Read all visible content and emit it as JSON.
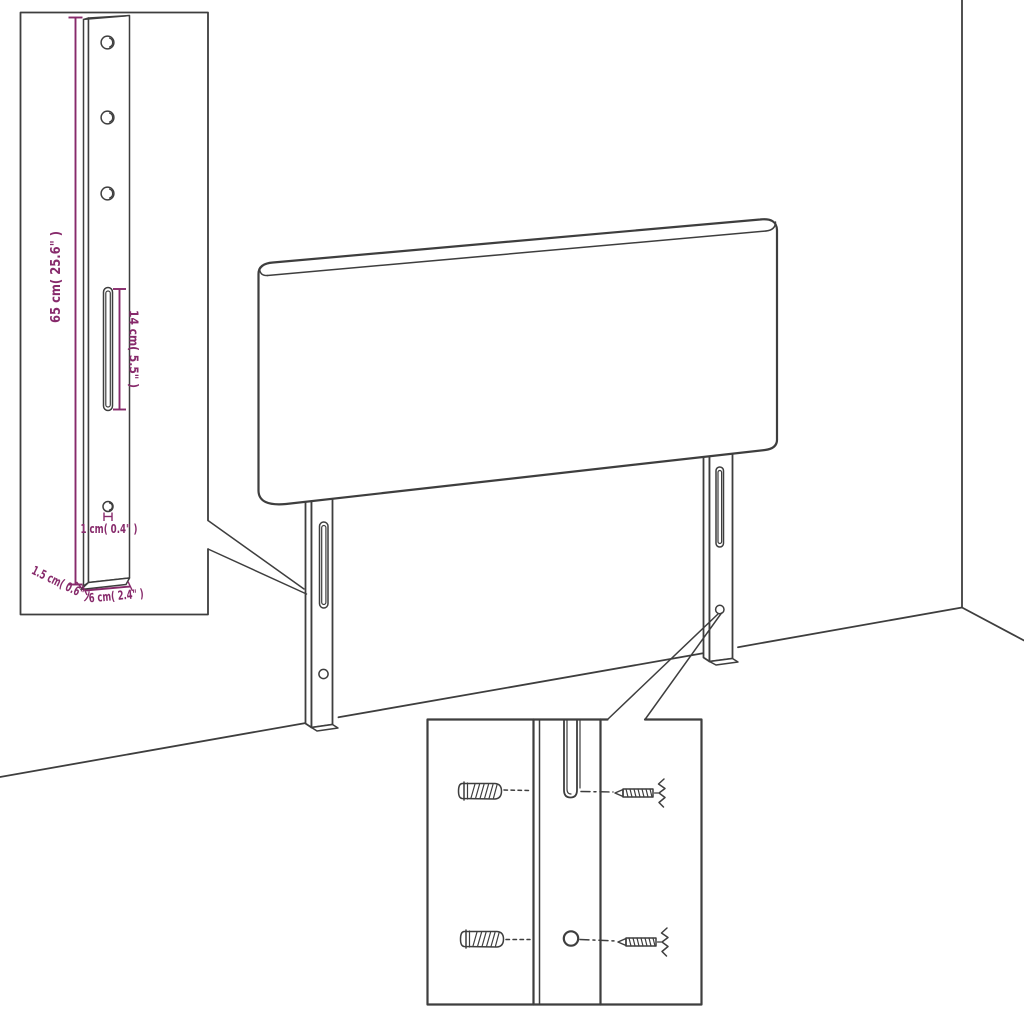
{
  "colors": {
    "line": "#3e3e3e",
    "dimension": "#872a6b",
    "background": "#ffffff"
  },
  "leg_detail": {
    "height_label": "65 cm( 25.6\" )",
    "slot_label": "14 cm( 5.5\" )",
    "hole_label": "1 cm( 0.4\" )",
    "thickness_label": "1.5 cm( 0.6\" )",
    "width_label": "6 cm( 2.4\" )"
  }
}
